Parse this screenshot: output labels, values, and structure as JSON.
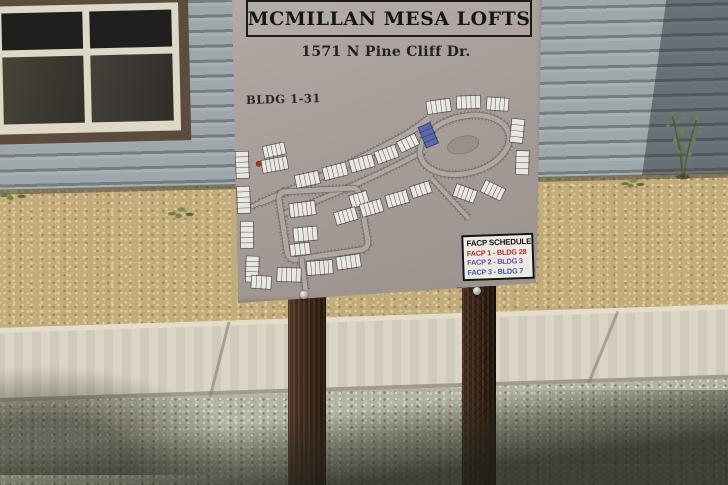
{
  "scene": {
    "description": "Photograph of the McMillan Mesa Lofts directory sign on two dark wooden posts, in front of a gray lap-sided building with a dark window, tan gravel landscaping, a diagonal concrete sidewalk and gray gravel in the foreground",
    "colors": {
      "siding": "#9ea7ab",
      "siding_shadow": "#6e777b",
      "window_trim": "#5c4c3e",
      "window_mullion": "#ded8c7",
      "gravel_tan": "#c3ac7c",
      "sidewalk": "#d8d2c1",
      "gravel_gray": "#b3b3a2",
      "post_wood": "#46301f",
      "sign_panel": "#a79d99"
    }
  },
  "sign": {
    "title": "MCMILLAN MESA LOFTS",
    "address": "1571 N Pine Cliff Dr.",
    "bldg_range_label": "BLDG 1-31",
    "directory_label": "DIRECTORY",
    "facp": {
      "title": "FACP SCHEDULE",
      "rows": [
        {
          "label": "FACP 1 - BLDG 28",
          "color": "#a82e26"
        },
        {
          "label": "FACP 2 - BLDG 3",
          "color": "#6a4e9e"
        },
        {
          "label": "FACP 3 - BLDG 7",
          "color": "#3c57a6"
        }
      ]
    },
    "map": {
      "road_edge": "#7b726d",
      "road_fill": "#b1a7a2",
      "tick_color": "rgba(70,62,56,0.5)",
      "building_fill": "#eae7e2",
      "building_stroke": "#524d49",
      "marker_red": "#b23228",
      "marker_blue": "#5a68a8",
      "island_fill": "#9a908b",
      "island": {
        "cx": 231,
        "cy": 52,
        "rx": 16,
        "ry": 8.5,
        "angle": -12
      },
      "red_marker": {
        "x": 26,
        "y": 63
      },
      "roads": [
        {
          "d": "M 26,102 C 70,86 120,66 165,44 C 180,37 190,30 198,24",
          "w": 6
        },
        {
          "d": "M 44,116 C 95,98 145,80 192,56",
          "w": 5
        },
        {
          "d": "M 50,92 Q 44,93 45,101 L 51,152 Q 52,161 61,160 L 124,153 Q 133,152 132,143 L 126,99 Q 125,90 116,91 Z",
          "w": 5.5
        },
        {
          "d": "M 188,62 A 45,28 -12 1 1 277,42 A 45,28 -12 1 1 188,62 Z",
          "w": 5.5
        },
        {
          "d": "M 65,158 L 68,191",
          "w": 5
        },
        {
          "d": "M 198,84 L 234,126",
          "w": 4.5
        },
        {
          "d": "M 26,102 L 13,107",
          "w": 4
        }
      ],
      "buildings": [
        {
          "x": 3,
          "y": 50,
          "w": 13,
          "h": 27,
          "a": 0,
          "u": 5
        },
        {
          "x": 3,
          "y": 85,
          "w": 13,
          "h": 27,
          "a": 0,
          "u": 5
        },
        {
          "x": 5,
          "y": 120,
          "w": 13,
          "h": 27,
          "a": 2,
          "u": 5
        },
        {
          "x": 9,
          "y": 155,
          "w": 13,
          "h": 26,
          "a": 4,
          "u": 5
        },
        {
          "x": 31,
          "y": 44,
          "w": 22,
          "h": 12,
          "a": -10,
          "u": 5
        },
        {
          "x": 29,
          "y": 58,
          "w": 26,
          "h": 13,
          "a": -8,
          "u": 6
        },
        {
          "x": 62,
          "y": 74,
          "w": 24,
          "h": 13,
          "a": -10,
          "u": 5
        },
        {
          "x": 90,
          "y": 67,
          "w": 24,
          "h": 13,
          "a": -12,
          "u": 5
        },
        {
          "x": 117,
          "y": 60,
          "w": 24,
          "h": 13,
          "a": -14,
          "u": 5
        },
        {
          "x": 143,
          "y": 52,
          "w": 22,
          "h": 13,
          "a": -18,
          "u": 5
        },
        {
          "x": 166,
          "y": 42,
          "w": 20,
          "h": 12,
          "a": -24,
          "u": 4
        },
        {
          "x": 190,
          "y": 30,
          "w": 13,
          "h": 22,
          "a": -20,
          "u": 4,
          "c": "blue"
        },
        {
          "x": 55,
          "y": 103,
          "w": 26,
          "h": 14,
          "a": -5,
          "u": 6
        },
        {
          "x": 58,
          "y": 128,
          "w": 24,
          "h": 14,
          "a": -3,
          "u": 5
        },
        {
          "x": 116,
          "y": 96,
          "w": 18,
          "h": 13,
          "a": -15,
          "u": 4
        },
        {
          "x": 100,
          "y": 112,
          "w": 22,
          "h": 13,
          "a": -14,
          "u": 5
        },
        {
          "x": 126,
          "y": 105,
          "w": 22,
          "h": 13,
          "a": -14,
          "u": 5
        },
        {
          "x": 152,
          "y": 97,
          "w": 22,
          "h": 13,
          "a": -14,
          "u": 5
        },
        {
          "x": 177,
          "y": 89,
          "w": 20,
          "h": 12,
          "a": -16,
          "u": 4
        },
        {
          "x": 14,
          "y": 175,
          "w": 20,
          "h": 13,
          "a": 6,
          "u": 4
        },
        {
          "x": 40,
          "y": 168,
          "w": 24,
          "h": 14,
          "a": 4,
          "u": 5
        },
        {
          "x": 70,
          "y": 162,
          "w": 26,
          "h": 14,
          "a": -2,
          "u": 6
        },
        {
          "x": 100,
          "y": 158,
          "w": 24,
          "h": 13,
          "a": -6,
          "u": 5
        },
        {
          "x": 196,
          "y": 6,
          "w": 24,
          "h": 13,
          "a": -6,
          "u": 5
        },
        {
          "x": 226,
          "y": 3,
          "w": 24,
          "h": 13,
          "a": 0,
          "u": 5
        },
        {
          "x": 256,
          "y": 6,
          "w": 22,
          "h": 13,
          "a": 6,
          "u": 5
        },
        {
          "x": 279,
          "y": 28,
          "w": 13,
          "h": 24,
          "a": 8,
          "u": 4
        },
        {
          "x": 283,
          "y": 60,
          "w": 13,
          "h": 24,
          "a": 4,
          "u": 4
        },
        {
          "x": 248,
          "y": 92,
          "w": 22,
          "h": 13,
          "a": 28,
          "u": 5
        },
        {
          "x": 220,
          "y": 94,
          "w": 22,
          "h": 13,
          "a": 22,
          "u": 5
        },
        {
          "x": 54,
          "y": 144,
          "w": 20,
          "h": 12,
          "a": -4,
          "u": 4
        }
      ]
    }
  }
}
